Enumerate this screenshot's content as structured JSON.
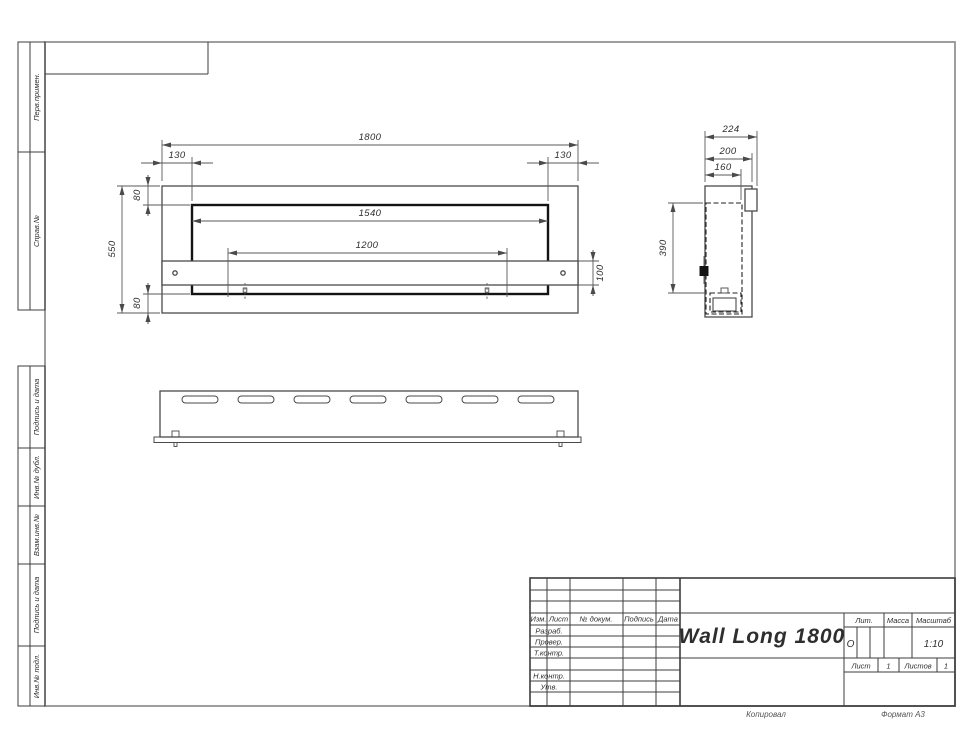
{
  "sheet": {
    "margin_top_block": [
      "Перв.примен.",
      "Справ.№"
    ],
    "margin_bottom_block": [
      "Подпись и дата",
      "Инв.№ дубл.",
      "Взам.инв.№",
      "Подпись и дата",
      "Инв.№ подл."
    ],
    "footer": {
      "copied": "Копировал",
      "format": "Формат А3"
    }
  },
  "views": {
    "front": {
      "dim_width": "1800",
      "dim_left_offset": "130",
      "dim_right_offset": "130",
      "dim_opening_width": "1540",
      "dim_mount_span": "1200",
      "dim_height": "550",
      "dim_top_inset": "80",
      "dim_bottom_inset": "80",
      "dim_bracket_height": "100"
    },
    "side": {
      "dim_depth_total": "224",
      "dim_depth_body": "200",
      "dim_depth_inner": "160",
      "dim_inner_height": "390"
    }
  },
  "title_block": {
    "rev_cols": [
      "Изм.",
      "Лист",
      "№ докум.",
      "Подпись",
      "Дата"
    ],
    "sig_rows": [
      "Разраб.",
      "Провер.",
      "Т.контр.",
      "Н.контр.",
      "Утв."
    ],
    "doc_name": "Wall Long 1800",
    "lit_label": "Лит.",
    "lit_value": "О",
    "mass_label": "Масса",
    "scale_label": "Масштаб",
    "scale_value": "1:10",
    "sheet_label": "Лист",
    "sheet_value": "1",
    "sheets_label": "Листов",
    "sheets_value": "1"
  }
}
